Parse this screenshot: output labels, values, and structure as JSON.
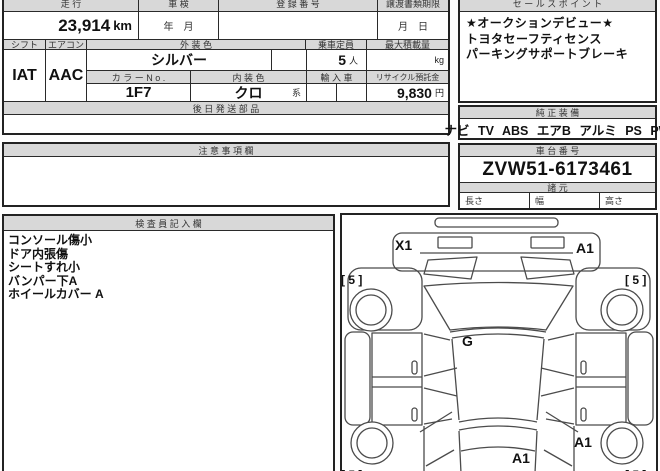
{
  "colors": {
    "header_bg": "#d8d8d8",
    "border": "#222222",
    "diagram_stroke": "#4b4b4b",
    "text": "#111111"
  },
  "top_table": {
    "mileage_label": "走 行",
    "mileage_value": "23,914",
    "mileage_unit": "km",
    "inspection_label": "車 検",
    "inspection_value": "年　月",
    "registration_label": "登 録 番 号",
    "registration_value": "",
    "transfer_label": "譲渡書類期限",
    "transfer_value": "月　日",
    "shift_label": "シフト",
    "shift_value": "IAT",
    "aircon_label": "エアコン",
    "aircon_value": "AAC",
    "ext_color_label": "外 装 色",
    "ext_color_value": "シルバー",
    "capacity_label": "乗車定員",
    "capacity_value": "5",
    "capacity_unit": "人",
    "max_load_label": "最大積載量",
    "max_load_unit": "kg",
    "color_no_label": "カ ラ ー N o .",
    "color_no_value": "1F7",
    "int_color_label": "内 装 色",
    "int_color_value": "クロ",
    "int_color_suffix": "系",
    "import_label": "輸 入 車",
    "import_value": "",
    "recycle_label": "リサイクル預託金",
    "recycle_value": "9,830",
    "recycle_unit": "円",
    "later_parts_label": "後 日 発 送 部 品",
    "caution_label": "注 意 事 項 欄"
  },
  "sales": {
    "title": "セ ー ル ス ポ イ ン ト",
    "lines": [
      "★オークションデビュー★",
      "トヨタセーフティセンス",
      "パーキングサポートブレーキ"
    ]
  },
  "equipment": {
    "title": "純 正 装 備",
    "value": "ナビ TV ABS エアB アルミ PS PW"
  },
  "chassis": {
    "title": "車 台 番 号",
    "value": "ZVW51-6173461"
  },
  "specs": {
    "title": "諸 元",
    "length_label": "長さ",
    "width_label": "幅",
    "height_label": "高さ"
  },
  "inspector": {
    "title": "検 査 員 記 入 欄",
    "notes": [
      "コンソール傷小",
      "ドア内張傷",
      "シートすれ小",
      "バンパー下A",
      "ホイールカバー A"
    ]
  },
  "diagram": {
    "damage_labels": [
      {
        "text": "X1",
        "location": "front-bumper-left"
      },
      {
        "text": "A1",
        "location": "front-bumper-right"
      },
      {
        "text": "[ 5 ]",
        "location": "front-left-tire"
      },
      {
        "text": "[ 5 ]",
        "location": "front-right-tire"
      },
      {
        "text": "G",
        "location": "windshield"
      },
      {
        "text": "A1",
        "location": "rear-center"
      },
      {
        "text": "A1",
        "location": "rear-right-quarter"
      },
      {
        "text": "[ 5 ]",
        "location": "rear-left-tire"
      },
      {
        "text": "[ 5 ]",
        "location": "rear-right-tire"
      }
    ]
  }
}
